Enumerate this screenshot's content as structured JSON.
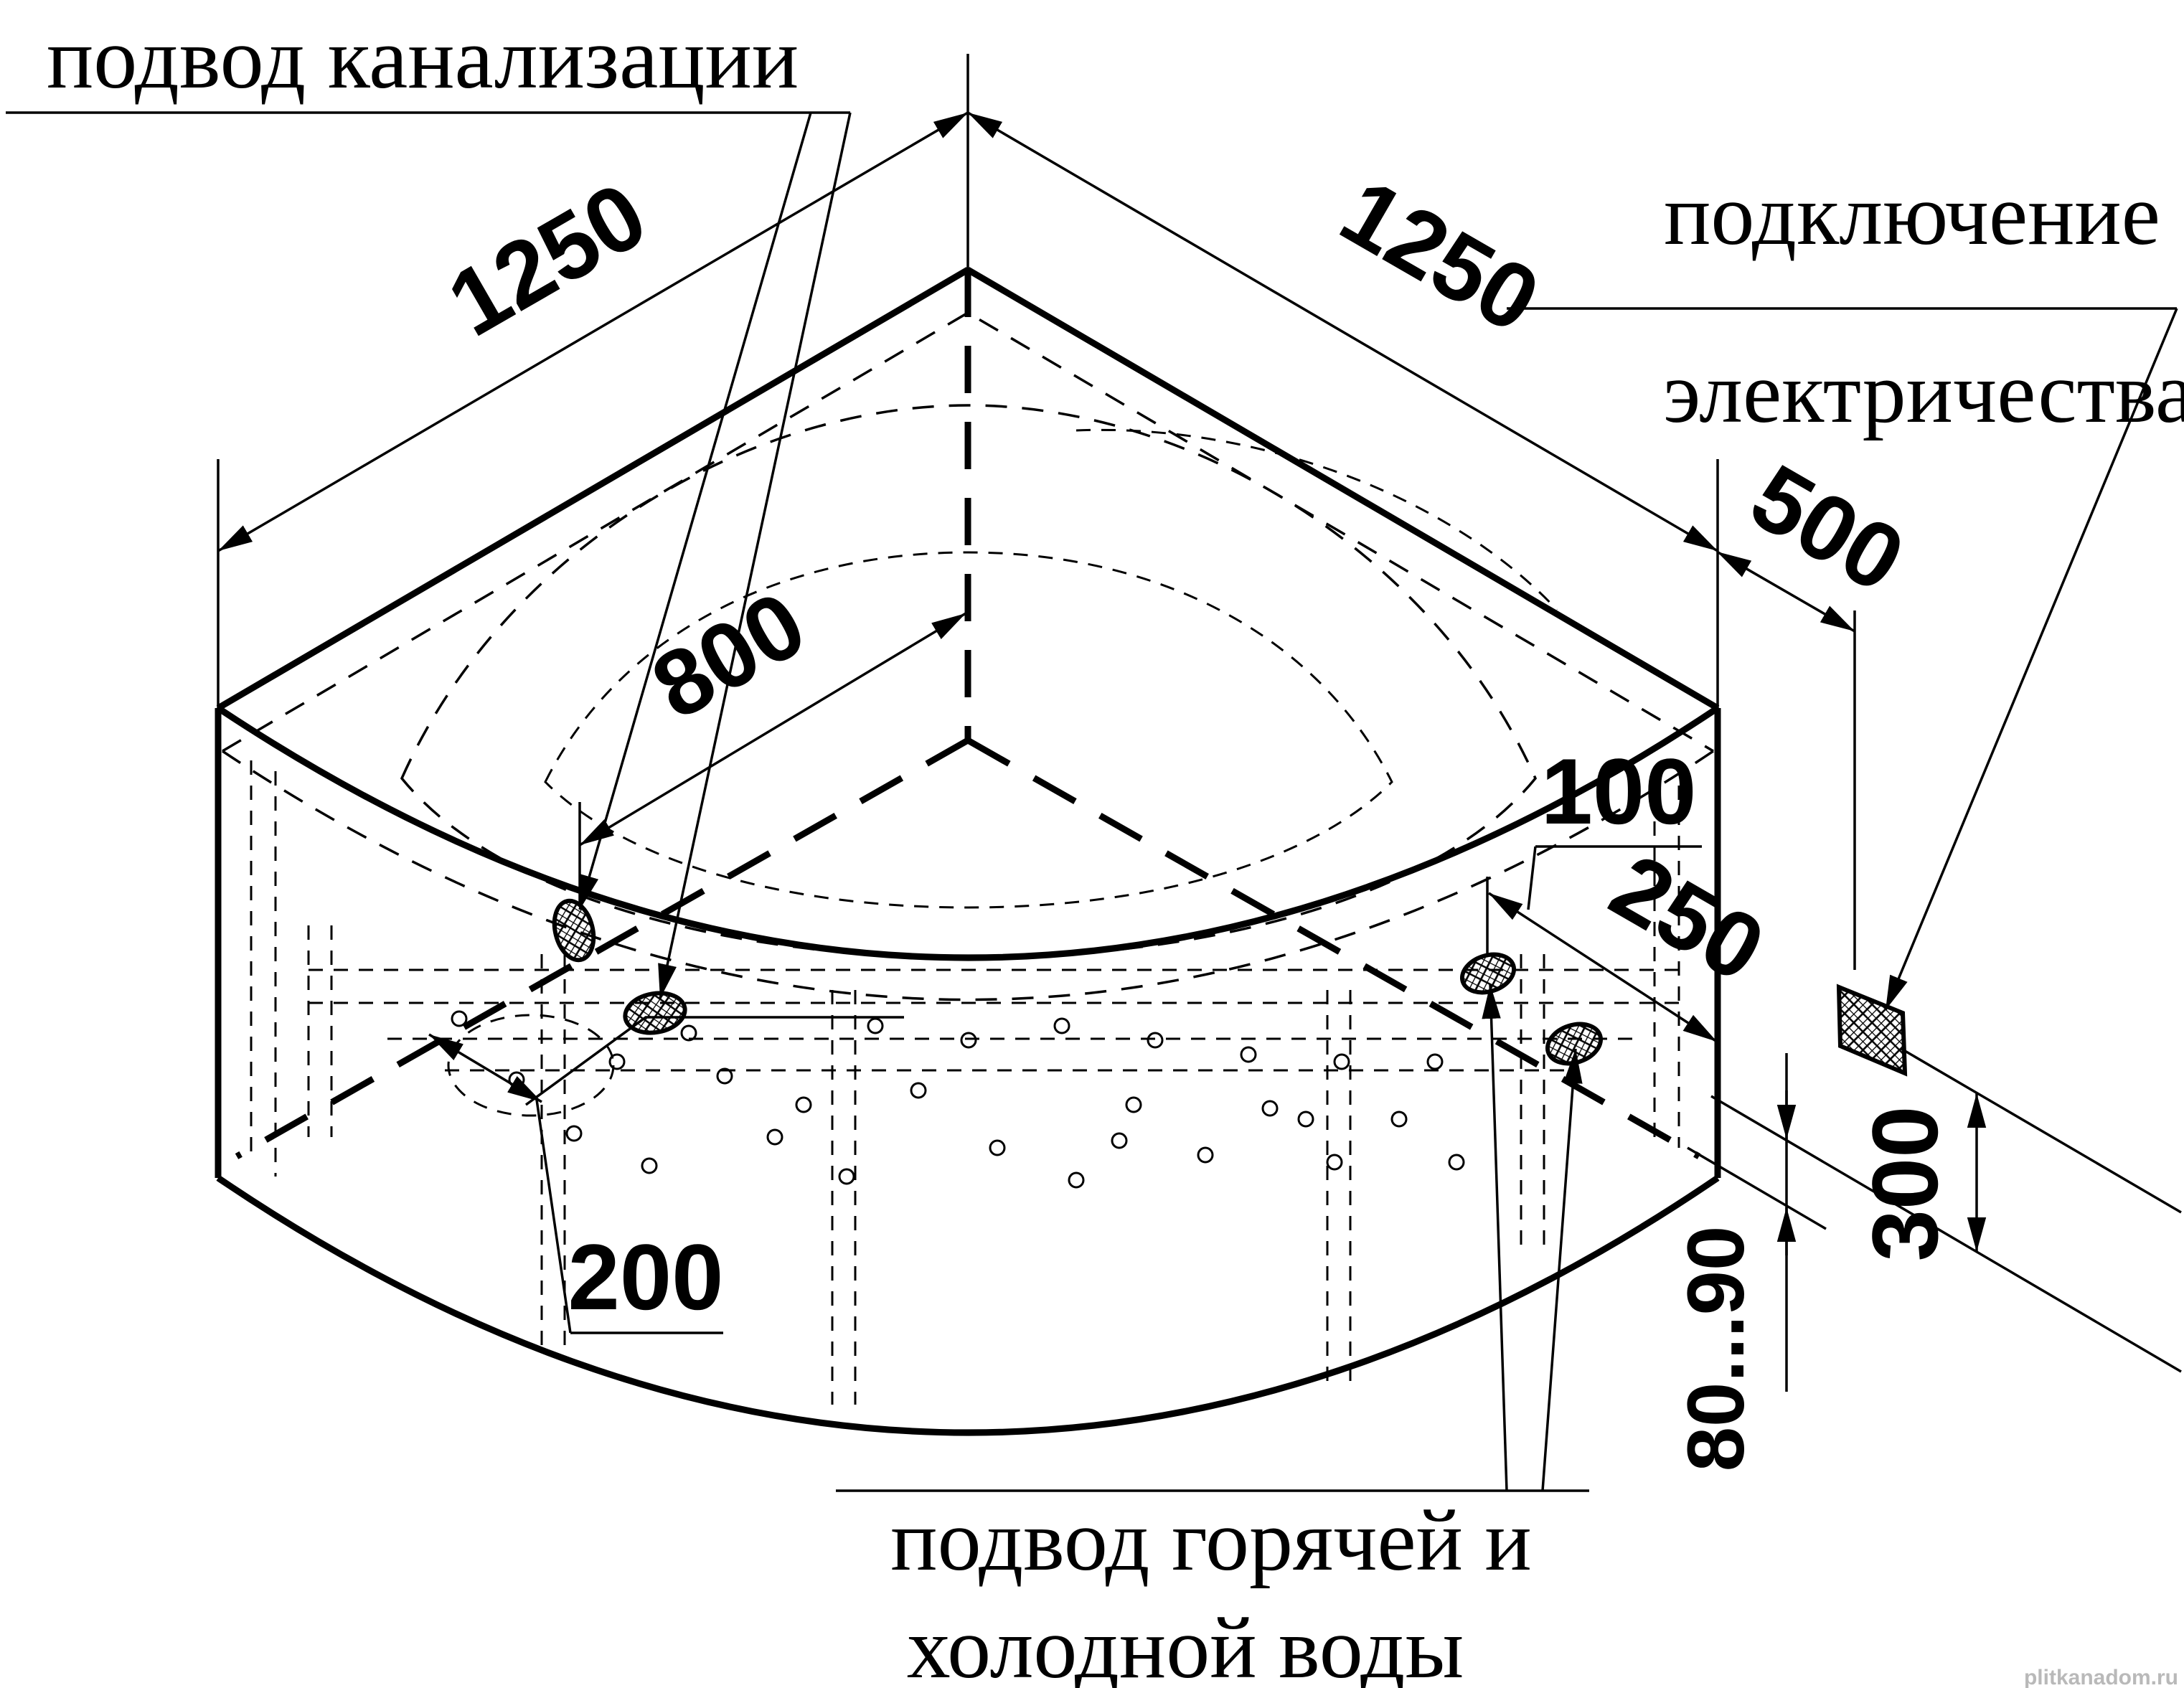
{
  "document": {
    "type": "bathtub-installation-diagram",
    "description": "Isometric wireframe installation drawing of a corner whirlpool bathtub with utility connection points and dimensions in millimetres",
    "background_color": "#ffffff",
    "line_color": "#000000",
    "watermark": "plitkanadom.ru"
  },
  "callouts": {
    "sewage": {
      "label": "подвод канализации"
    },
    "electric": {
      "label_line1": "подключение",
      "label_line2": "электричества"
    },
    "water": {
      "label_line1": "подвод горячей и",
      "label_line2": "холодной воды"
    }
  },
  "dimensions_mm": [
    {
      "id": "side-width-left",
      "value": "1250"
    },
    {
      "id": "side-width-right",
      "value": "1250"
    },
    {
      "id": "drain-offset-from-corner",
      "value": "800"
    },
    {
      "id": "electric-offset-from-wall",
      "value": "500"
    },
    {
      "id": "rim-wall-gap",
      "value": "100"
    },
    {
      "id": "water-offset-from-wall",
      "value": "250"
    },
    {
      "id": "drain-spacing",
      "value": "200"
    },
    {
      "id": "electric-height",
      "value": "300"
    },
    {
      "id": "feet-adjust-height",
      "value": "80...90"
    }
  ],
  "labels": {
    "sewage": "подвод канализации",
    "electric1": "подключение",
    "electric2": "электричества",
    "water1": "подвод горячей и",
    "water2": "холодной воды",
    "dim_1250_left": "1250",
    "dim_1250_right": "1250",
    "dim_800": "800",
    "dim_500": "500",
    "dim_100": "100",
    "dim_250": "250",
    "dim_200": "200",
    "dim_300": "300",
    "dim_feet": "80...90",
    "watermark": "plitkanadom.ru"
  }
}
